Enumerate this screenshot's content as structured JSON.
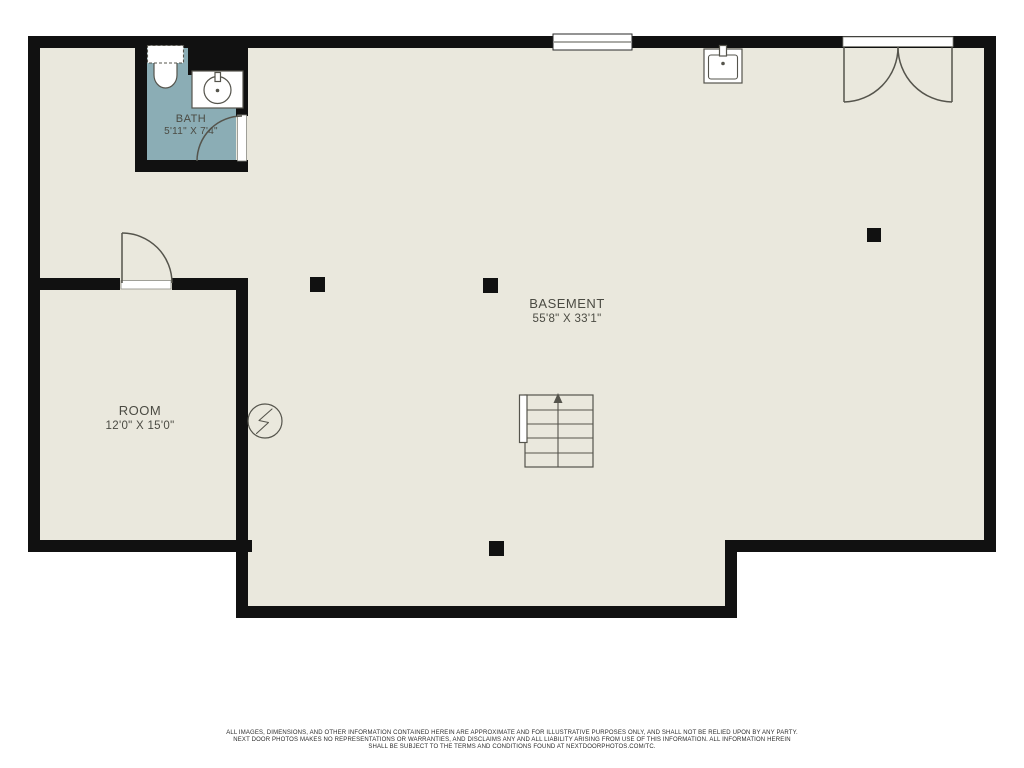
{
  "plan": {
    "rooms": [
      {
        "name": "BATH",
        "dims": "5'11\" X 7'4\""
      },
      {
        "name": "ROOM",
        "dims": "12'0\" X 15'0\""
      },
      {
        "name": "BASEMENT",
        "dims": "55'8\" X 33'1\""
      }
    ],
    "stairs_direction": "up",
    "fixtures": [
      "toilet",
      "vanity-sink",
      "utility-sink",
      "stairs",
      "electrical-panel",
      "support-post"
    ],
    "colors": {
      "wall": "#111111",
      "floor": "#eae8dd",
      "bath_floor": "#8badb5",
      "line": "#55544c",
      "label": "#4b4b43"
    },
    "disclaimer": {
      "line1": "ALL IMAGES, DIMENSIONS, AND OTHER INFORMATION CONTAINED HEREIN ARE APPROXIMATE AND FOR ILLUSTRATIVE PURPOSES ONLY, AND SHALL NOT BE RELIED UPON BY ANY PARTY.",
      "line2": "NEXT DOOR PHOTOS MAKES NO REPRESENTATIONS OR WARRANTIES, AND DISCLAIMS ANY AND ALL LIABILITY ARISING FROM USE OF THIS INFORMATION. ALL INFORMATION HEREIN",
      "line3": "SHALL BE SUBJECT TO THE TERMS AND CONDITIONS FOUND AT NEXTDOORPHOTOS.COM/TC."
    }
  }
}
